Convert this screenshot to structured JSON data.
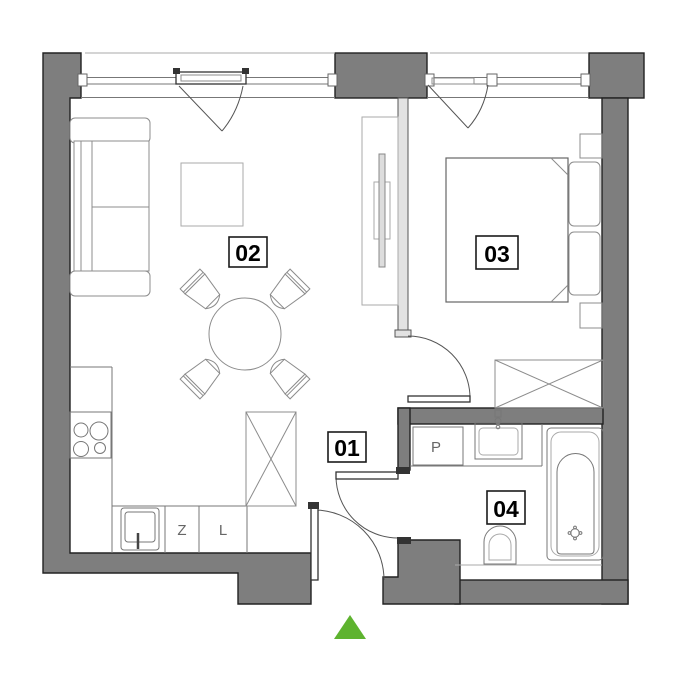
{
  "rooms": [
    {
      "label": "01"
    },
    {
      "label": "02"
    },
    {
      "label": "03"
    },
    {
      "label": "04"
    }
  ],
  "kitchen": {
    "cabinet_z_label": "Z",
    "cabinet_l_label": "L"
  },
  "bathroom": {
    "washer_label": "P"
  },
  "colors": {
    "wall": "#7e7e7e",
    "partition": "#e2e2e2",
    "entrance_arrow": "#5eb32f",
    "background": "#ffffff",
    "label_border": "#1a1a1a"
  }
}
